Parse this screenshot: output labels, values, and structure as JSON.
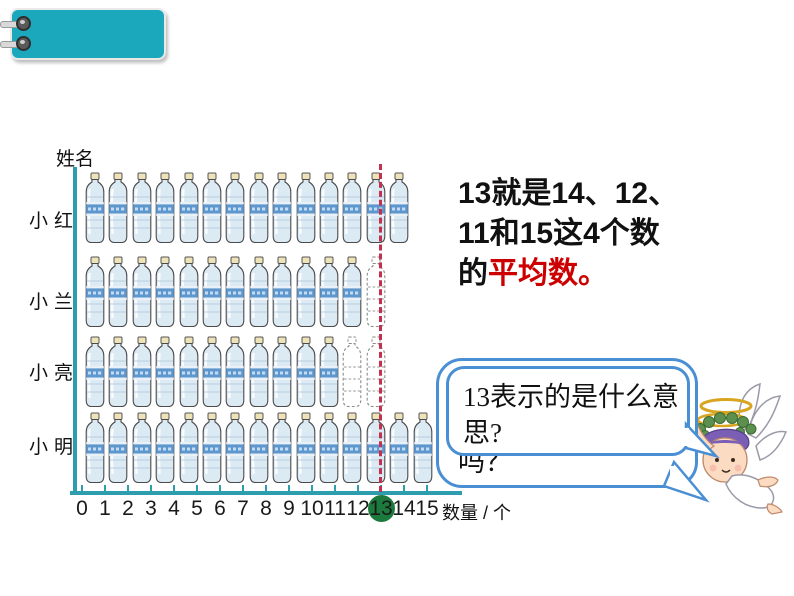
{
  "tab": {
    "color": "#1BA8BC"
  },
  "chart_data": {
    "type": "bar",
    "subtype": "pictograph-water-bottles",
    "categories": [
      "小红",
      "小兰",
      "小亮",
      "小明"
    ],
    "values": [
      14,
      12,
      11,
      15
    ],
    "ghost_values": [
      0,
      1,
      2,
      0
    ],
    "x_ticks": [
      "0",
      "1",
      "2",
      "3",
      "4",
      "5",
      "6",
      "7",
      "8",
      "9",
      "10",
      "11",
      "12",
      "13",
      "14",
      "15"
    ],
    "highlighted_tick": "13",
    "average": 13,
    "xlabel": "数量 / 个",
    "ylabel": "姓名",
    "xlim": [
      0,
      15
    ],
    "grid": false,
    "average_line_color": "#C2314E",
    "highlight_circle_color": "#1B7A3C",
    "axis_color": "#2E9EAF"
  },
  "annotation": {
    "line1": "13就是14、12、",
    "line2": "11和15这4个数",
    "line3_black": "的",
    "line3_red": "平均数。",
    "red_color": "#CC0000"
  },
  "bubble": {
    "text": "13表示的是什么意思?",
    "partial_text": "吗？",
    "border_color": "#4A8FD3"
  }
}
